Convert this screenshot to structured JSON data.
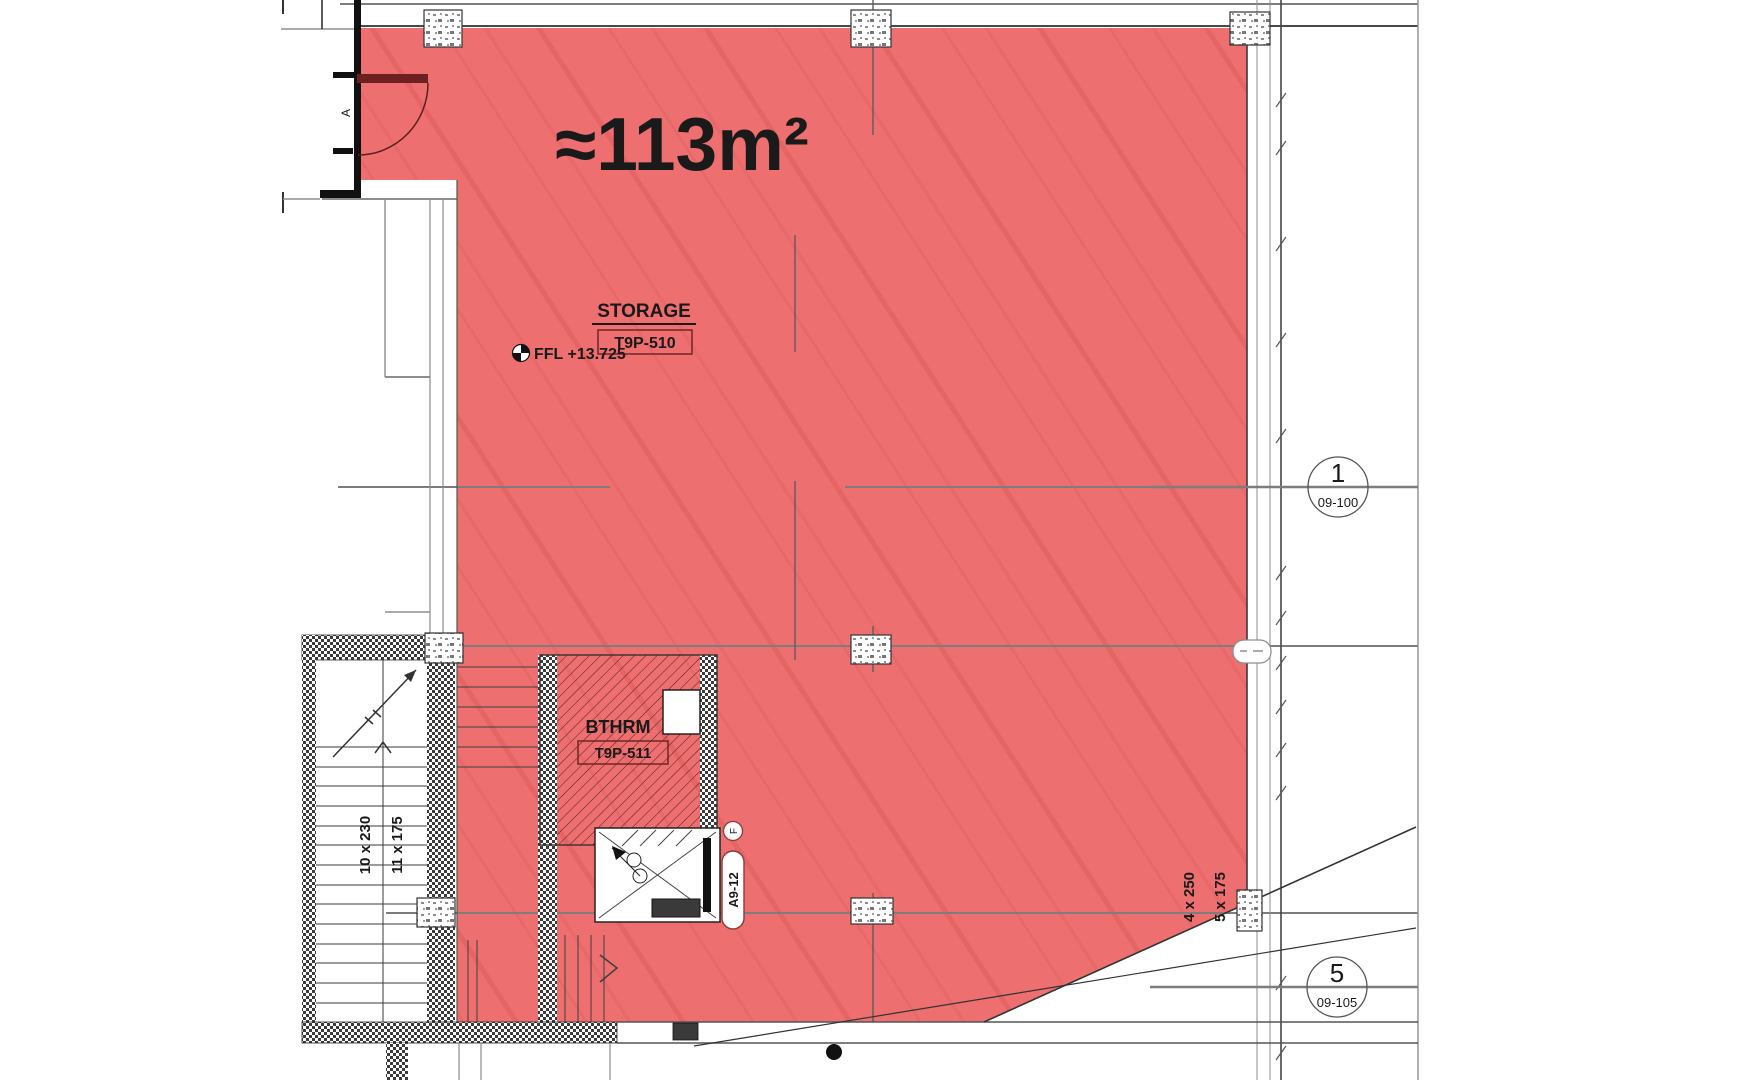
{
  "plan": {
    "area_label": "≈113m²",
    "storage": {
      "name": "STORAGE",
      "tag": "T9P-510"
    },
    "level_marker": "FFL +13.725",
    "bathroom": {
      "name": "BTHRM",
      "tag": "T9P-511"
    },
    "lift": {
      "tag": "A9-12",
      "bubble": "F"
    },
    "door_tag": "A",
    "stairs": {
      "left_run_a": "10 x 230",
      "left_run_b": "11 x 175",
      "right_run_a": "4 x 250",
      "right_run_b": "5 x 175"
    },
    "grid_bubbles": [
      {
        "number": "1",
        "ref": "09-100"
      },
      {
        "number": "5",
        "ref": "09-105"
      }
    ],
    "colors": {
      "highlight_fill": "#ee6f6f",
      "highlight_streak": "#b43232",
      "wall_dark": "#2f2f2f",
      "grid_gray": "#7d7d7d",
      "tag_border": "#6e2626",
      "door_leaf": "#6d2020"
    }
  }
}
